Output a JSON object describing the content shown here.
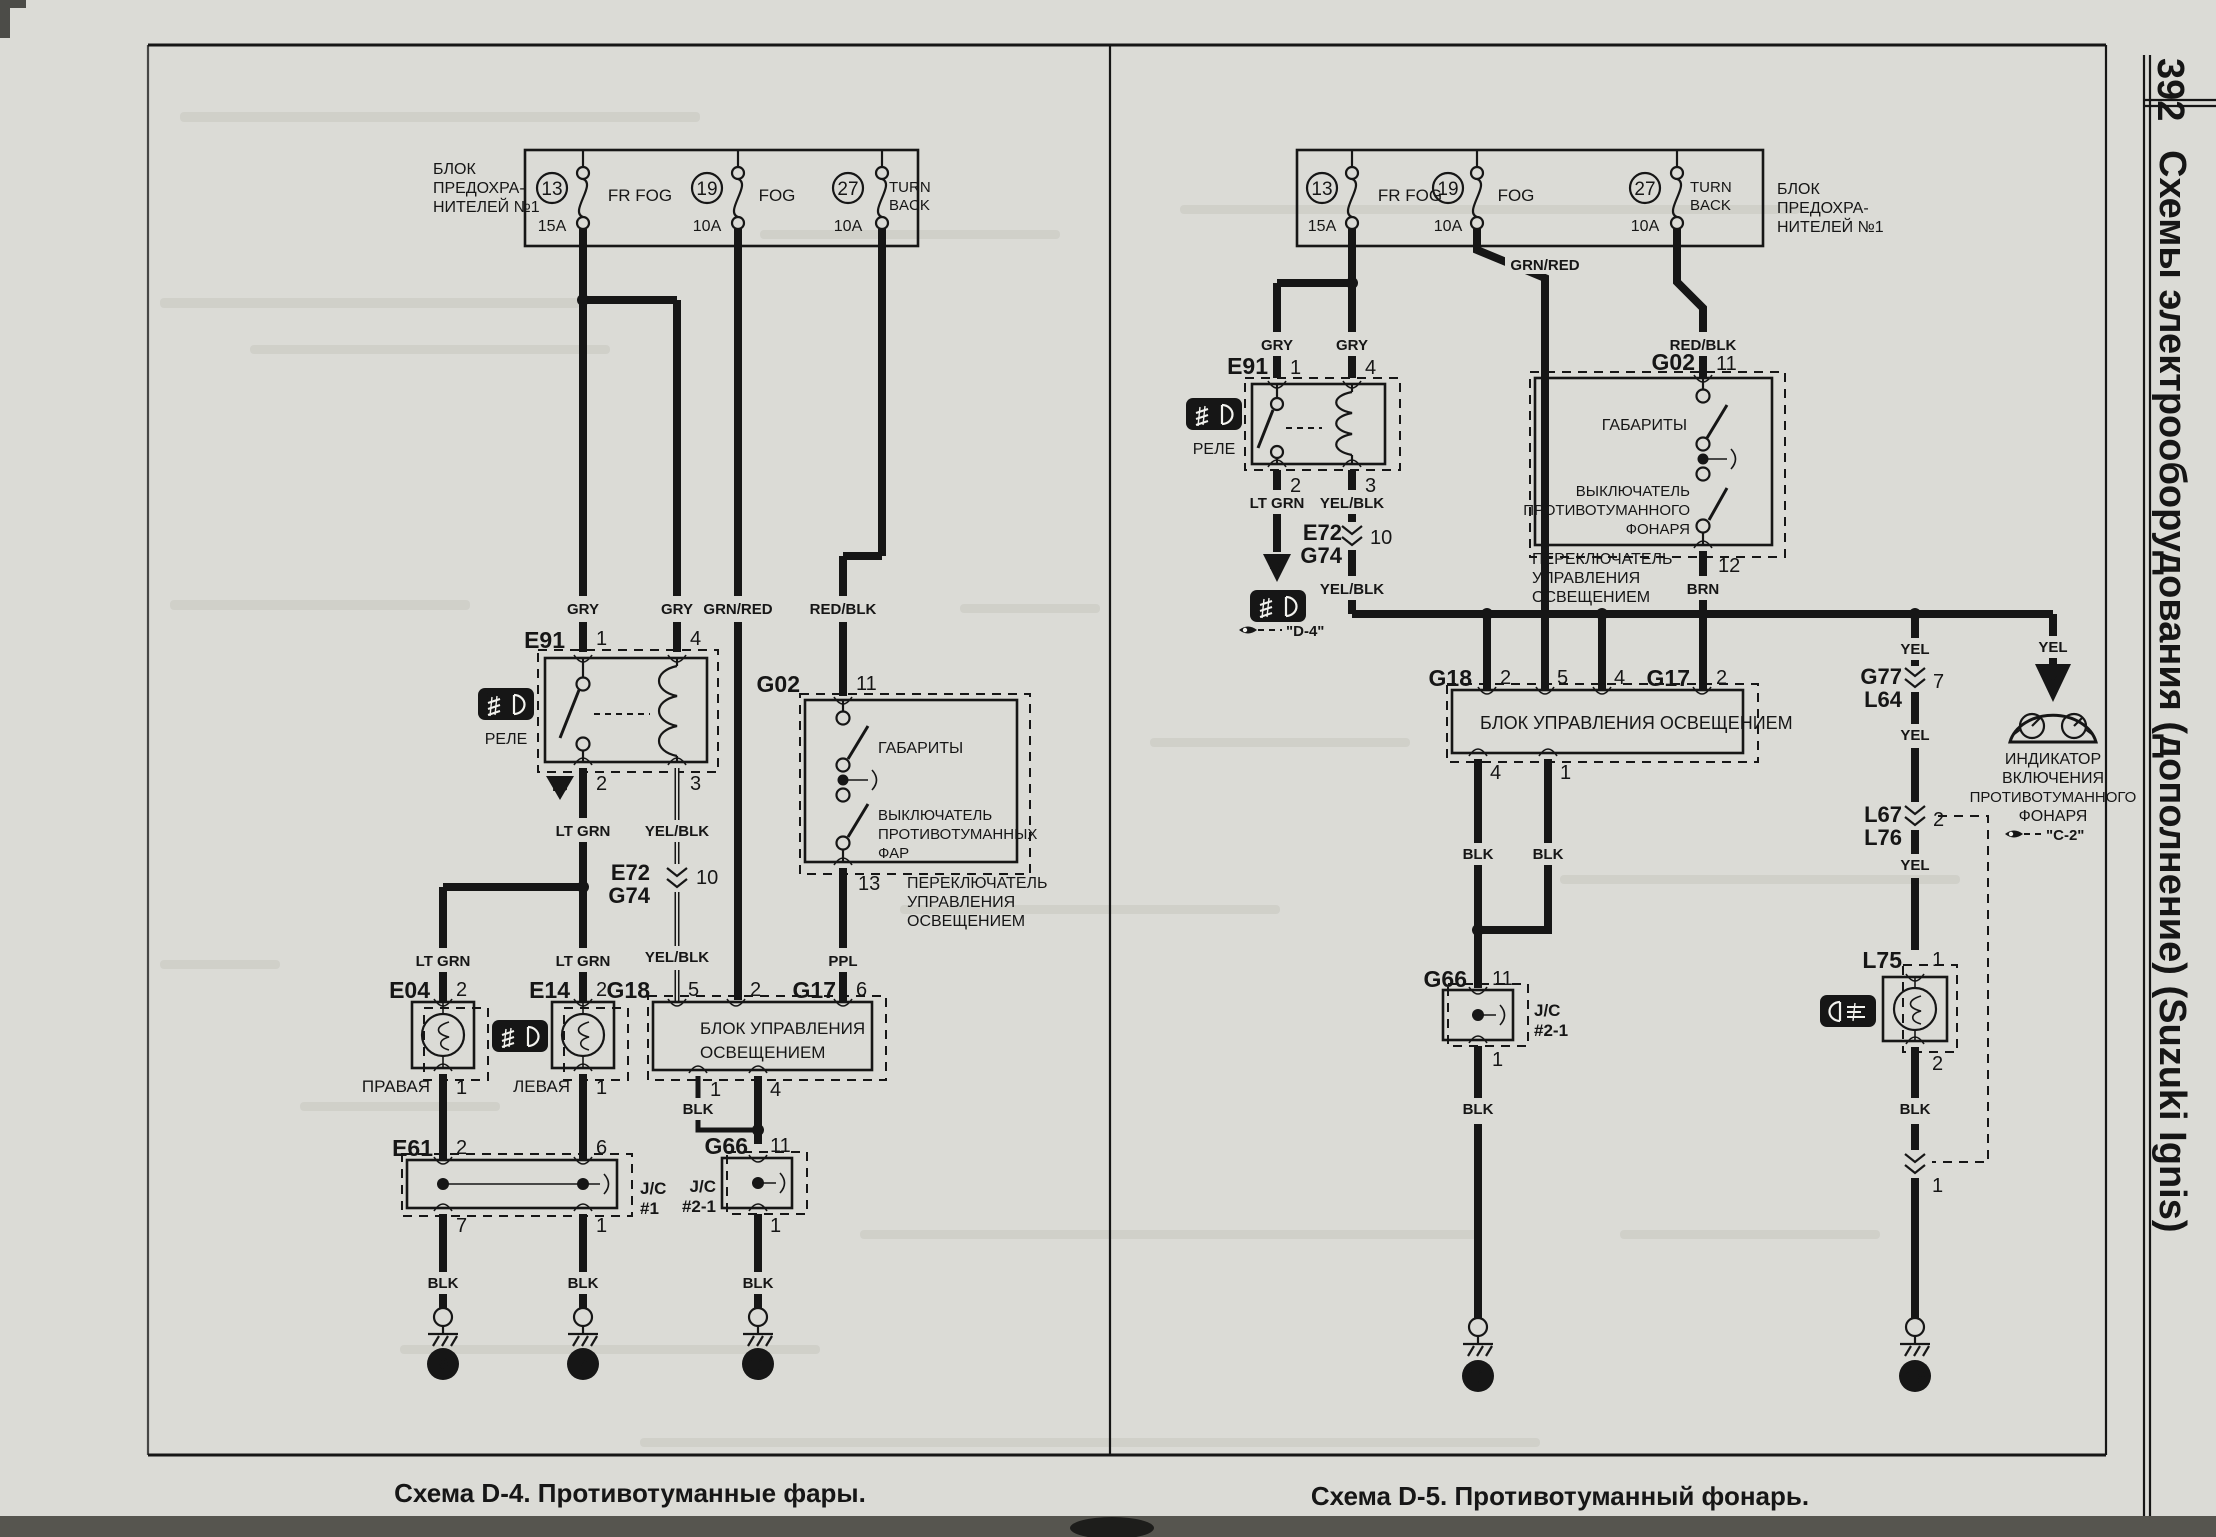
{
  "page": {
    "number": "392",
    "side_title": "Схемы электрооборудования (дополнение) (Suzuki Ignis)",
    "caption_d4": "Схема D-4. Противотуманные фары.",
    "caption_d5": "Схема D-5. Противотуманный фонарь."
  },
  "fusebox": {
    "label1": "БЛОК",
    "label2": "ПРЕДОХРА-",
    "label3": "НИТЕЛЕЙ №1",
    "f13": {
      "num": "13",
      "amp": "15A",
      "name": "FR FOG"
    },
    "f19": {
      "num": "19",
      "amp": "10A",
      "name": "FOG"
    },
    "f27": {
      "num": "27",
      "amp": "10A",
      "name1": "TURN",
      "name2": "BACK"
    }
  },
  "wires": {
    "gry": "GRY",
    "grnred": "GRN/RED",
    "redblk": "RED/BLK",
    "ltgrn": "LT GRN",
    "yelblk": "YEL/BLK",
    "ppl": "PPL",
    "blk": "BLK",
    "brn": "BRN",
    "yel": "YEL",
    "lg": "LG",
    "y": "Y"
  },
  "pins": {
    "n1": "1",
    "n2": "2",
    "n3": "3",
    "n4": "4",
    "n5": "5",
    "n6": "6",
    "n7": "7",
    "n10": "10",
    "n11": "11",
    "n12": "12",
    "n13": "13"
  },
  "comp": {
    "e91": "E91",
    "relay": "РЕЛЕ",
    "e72": "E72",
    "g74": "G74",
    "g02": "G02",
    "dims": "ГАБАРИТЫ",
    "fogsw1": "ВЫКЛЮЧАТЕЛЬ",
    "fogsw2": "ПРОТИВОТУМАННЫХ",
    "fogsw3": "ФАР",
    "rfogsw1": "ВЫКЛЮЧАТЕЛЬ",
    "rfogsw2": "ПРОТИВОТУМАННОГО",
    "rfogsw3": "ФОНАРЯ",
    "lsw1": "ПЕРЕКЛЮЧАТЕЛЬ",
    "lsw2": "УПРАВЛЕНИЯ",
    "lsw3": "ОСВЕЩЕНИЕМ",
    "ctrl1": "БЛОК УПРАВЛЕНИЯ",
    "ctrl2": "ОСВЕЩЕНИЕМ",
    "ctrl": "БЛОК УПРАВЛЕНИЯ ОСВЕЩЕНИЕМ",
    "g18": "G18",
    "g17": "G17",
    "e04": "E04",
    "e14": "E14",
    "lamp_right": "ПРАВАЯ",
    "lamp_left": "ЛЕВАЯ",
    "e61": "E61",
    "jc": "J/C",
    "jc1": "#1",
    "jc21": "#2-1",
    "g66": "G66",
    "g77": "G77",
    "l64": "L64",
    "l67": "L67",
    "l76": "L76",
    "l75": "L75",
    "ind1": "ИНДИКАТОР",
    "ind2": "ВКЛЮЧЕНИЯ",
    "ind3": "ПРОТИВОТУМАННОГО",
    "ind4": "ФОНАРЯ",
    "badge_tag": "FF0"
  },
  "refs": {
    "d4": "\"D-4\"",
    "c2": "\"C-2\""
  },
  "grounds": {
    "g7": "7",
    "g9": "9",
    "g11": "11",
    "g16": "16"
  }
}
